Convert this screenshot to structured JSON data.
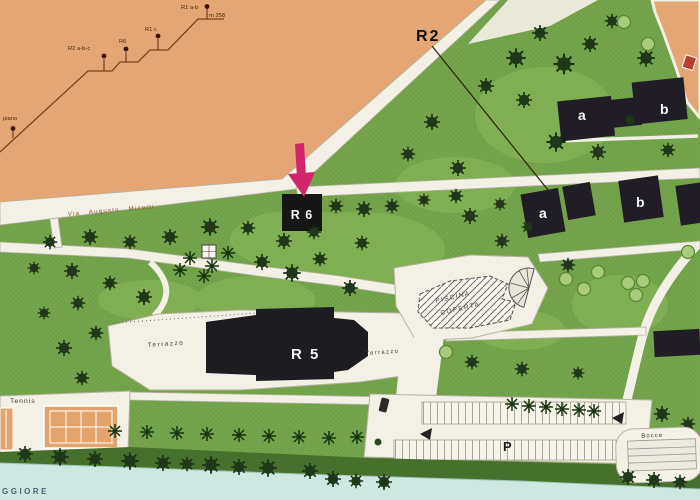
{
  "map": {
    "labels": {
      "r2": "R2",
      "r6": "R 6",
      "r5": "R 5",
      "terrazzo_left": "Terrazzo",
      "terrazzo_right": "Terrazzo",
      "piscina1": "PISCINA",
      "piscina2": "COPERTA",
      "tennis": "Tennis",
      "parking": "P",
      "bocce": "Bocce",
      "top_a": "a",
      "top_b": "b",
      "mid_a": "a",
      "mid_b": "b",
      "street": "Via Augusto Micotti",
      "water": "GGIORE"
    },
    "elevation": {
      "piano": "piano",
      "r2abc": "R2 a-b-c",
      "r6": "R6",
      "r1c": "R1 c",
      "r1ab": "R1 a-b",
      "alt": "m 258"
    },
    "colors": {
      "land": "#e4a674",
      "grass": "#73a34a",
      "water": "#cfe7e1",
      "road": "#f3f0e5",
      "building": "#211d26",
      "arrow_accent": "#d2256b"
    }
  }
}
